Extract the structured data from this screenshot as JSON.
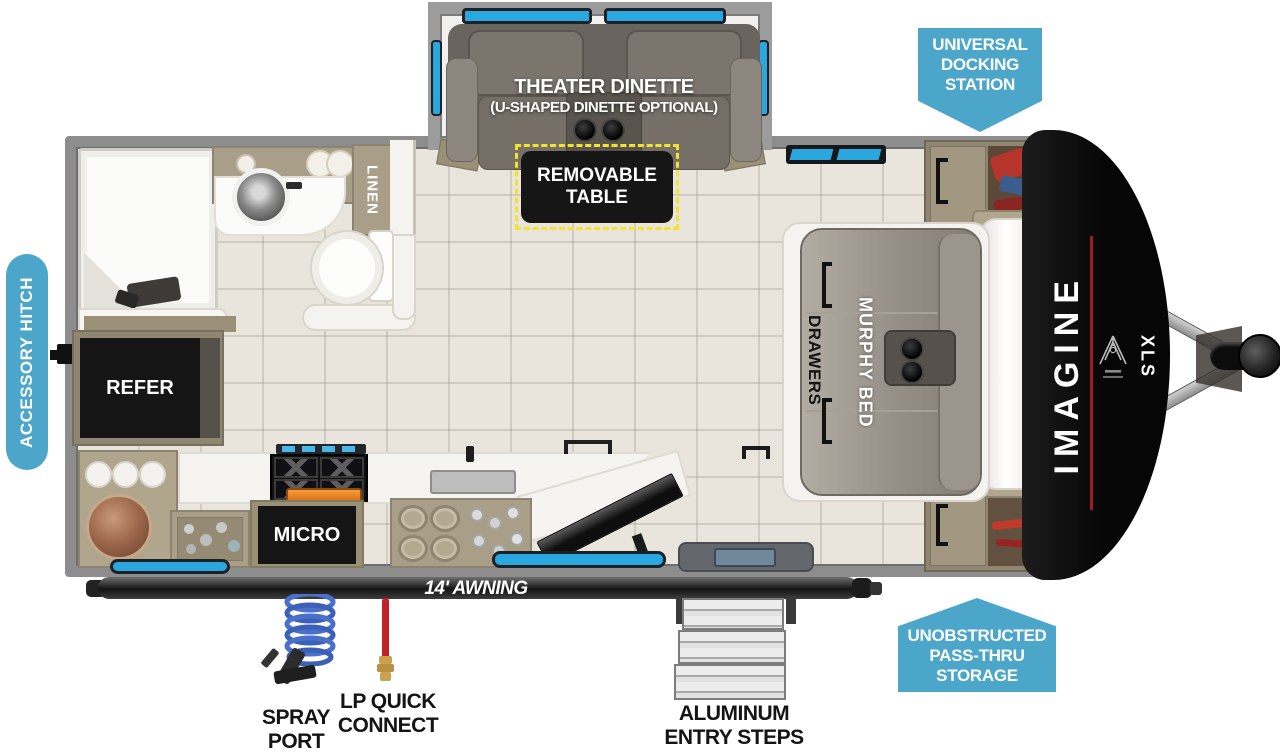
{
  "colors": {
    "callout_blue": "#4BA6C9",
    "window_cyan": "#2BA7DF",
    "brand_red": "#9E1B26",
    "table_highlight_yellow": "#F3E32B"
  },
  "callouts": {
    "universal_docking_station": {
      "line1": "UNIVERSAL",
      "line2": "DOCKING",
      "line3": "STATION"
    },
    "accessory_hitch": {
      "label": "ACCESSORY HITCH"
    },
    "unobstructed_storage": {
      "line1": "UNOBSTRUCTED",
      "line2": "PASS-THRU",
      "line3": "STORAGE"
    }
  },
  "floorplan": {
    "theater_dinette": {
      "title": "THEATER DINETTE",
      "subtitle": "(U-SHAPED DINETTE OPTIONAL)"
    },
    "removable_table": {
      "line1": "REMOVABLE",
      "line2": "TABLE"
    },
    "linen": "LINEN",
    "refer": "REFER",
    "micro": "MICRO",
    "murphy_bed": "MURPHY BED",
    "drawers": "DRAWERS",
    "awning": "14' AWNING",
    "brand": {
      "model": "IMAGINE",
      "trim": "XLS"
    }
  },
  "exterior": {
    "spray_port": {
      "line1": "SPRAY",
      "line2": "PORT"
    },
    "lp_quick_connect": {
      "line1": "LP QUICK",
      "line2": "CONNECT"
    },
    "entry_steps": {
      "line1": "ALUMINUM",
      "line2": "ENTRY STEPS"
    }
  }
}
